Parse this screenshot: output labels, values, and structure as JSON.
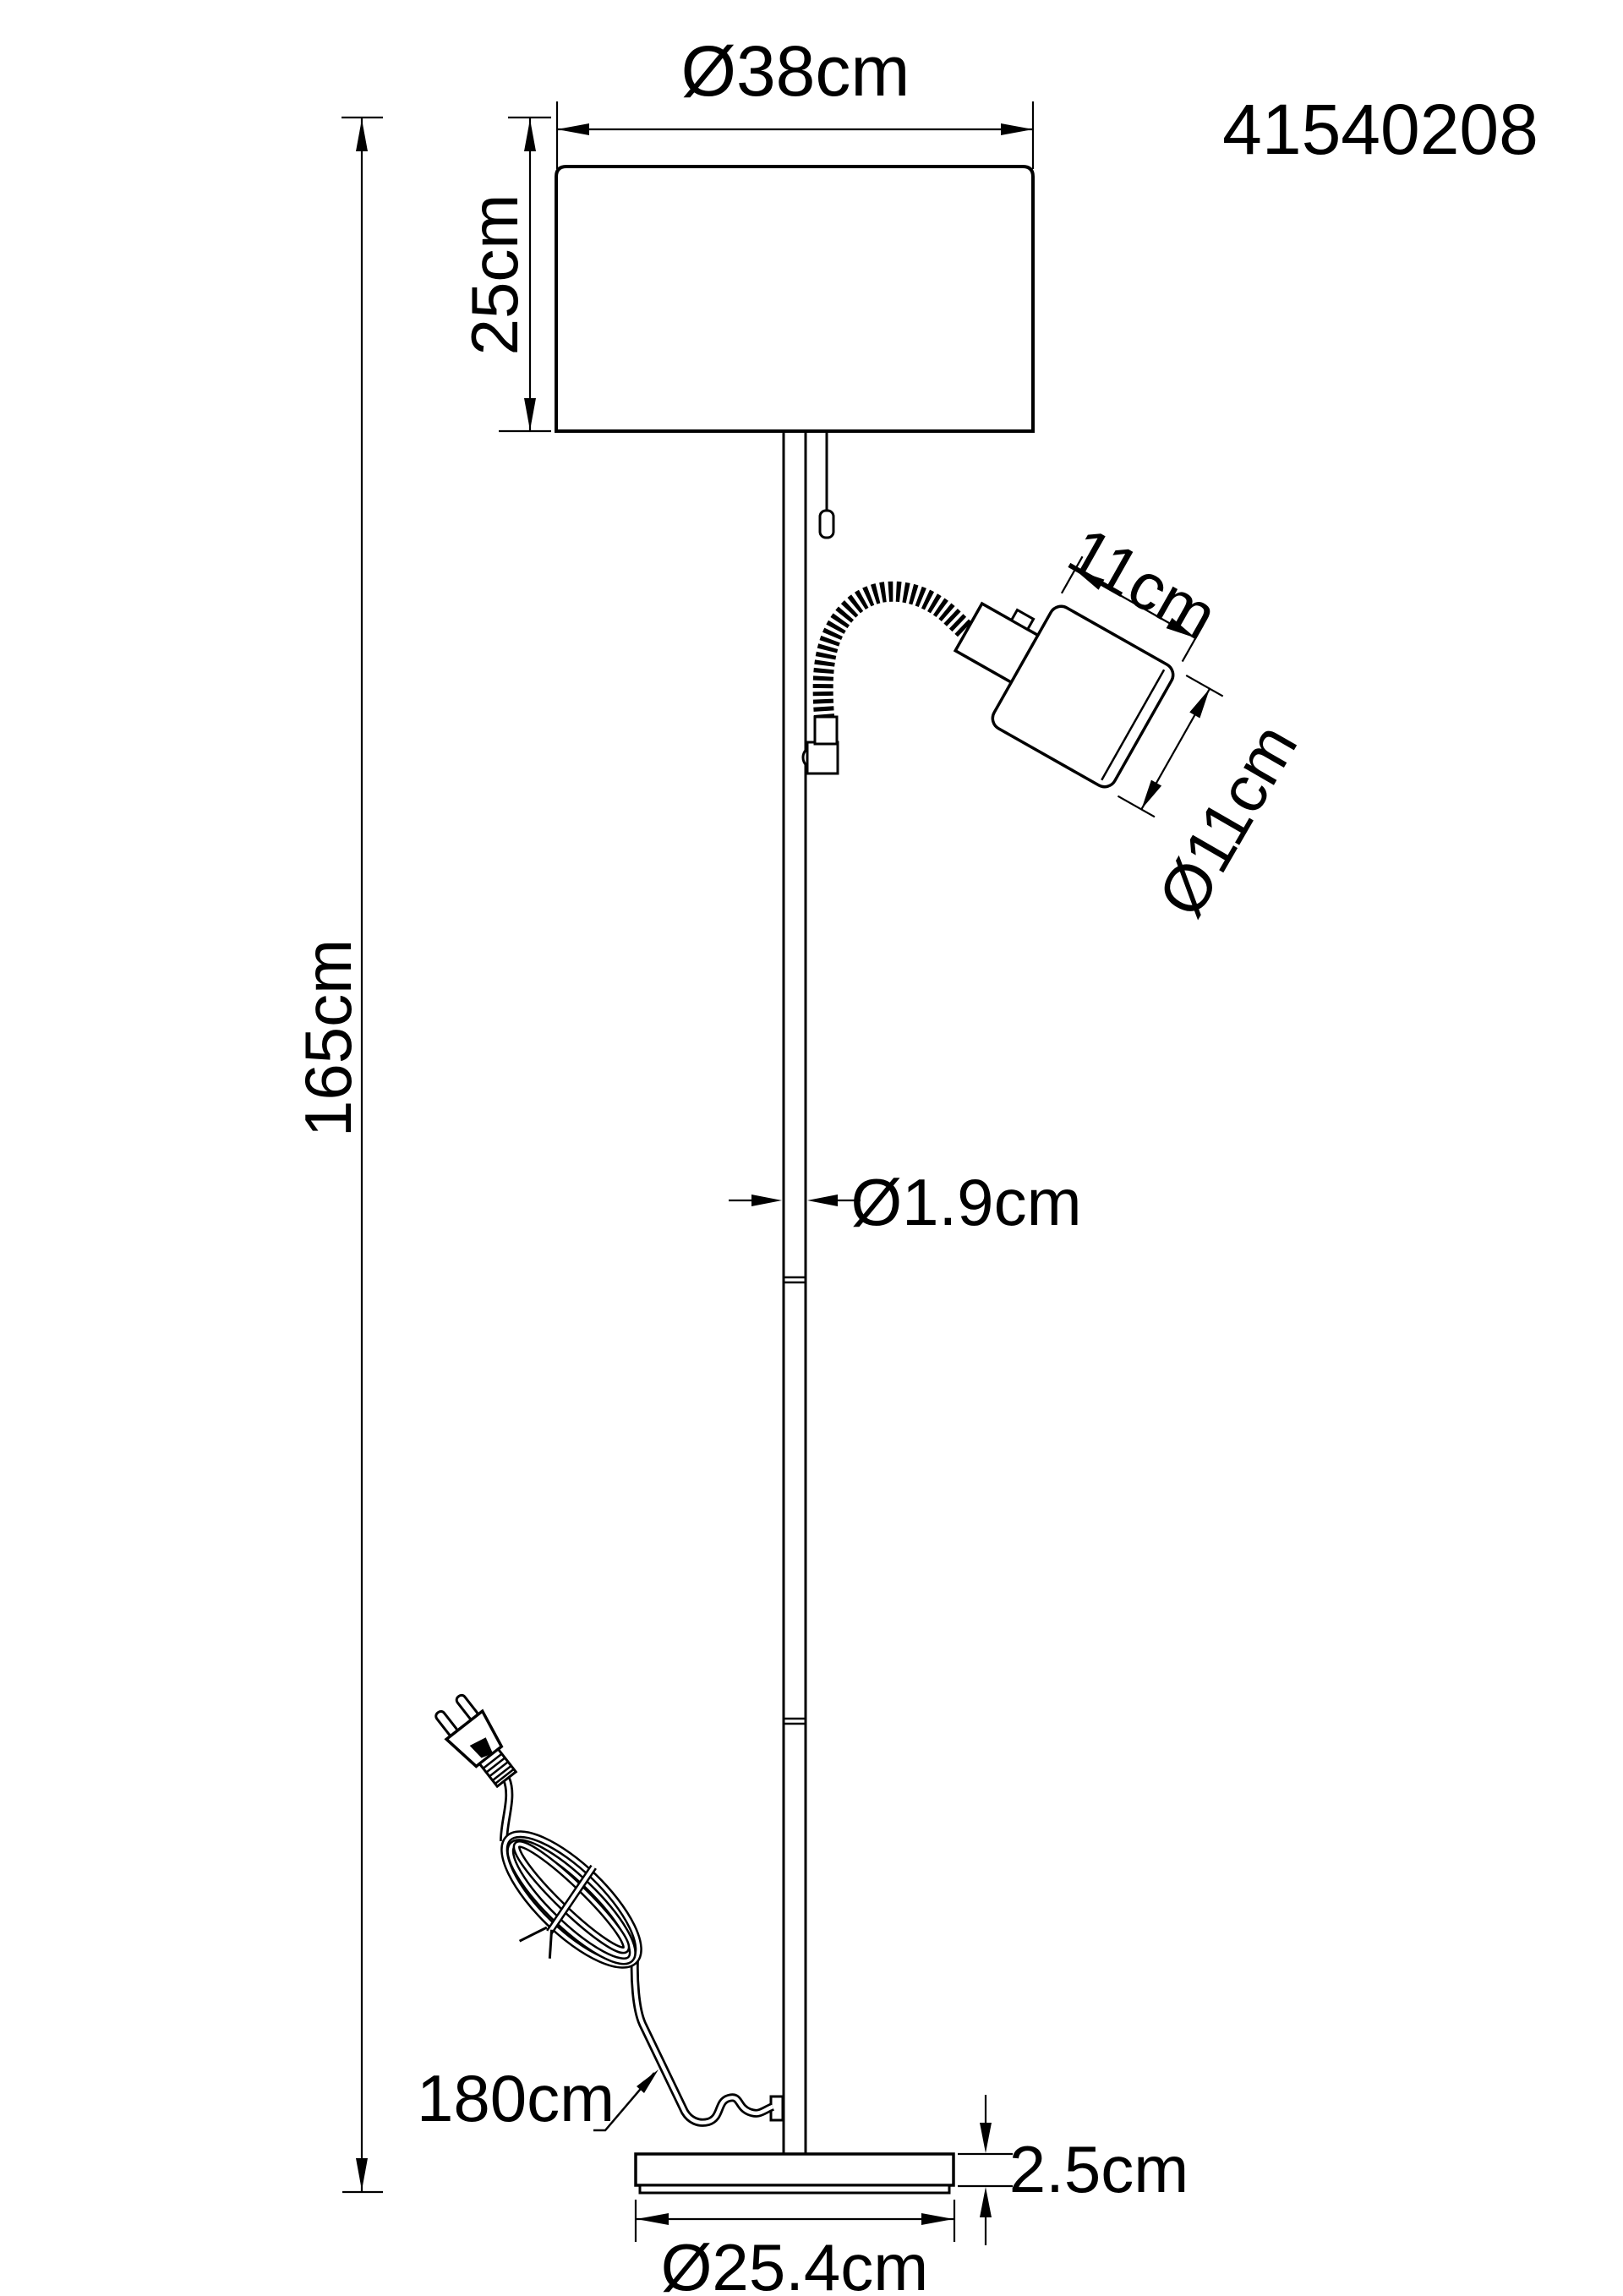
{
  "title": "Floor lamp technical dimension drawing",
  "product": {
    "part_number": "41540208"
  },
  "dimensions": {
    "shade_diameter": "Ø38cm",
    "shade_height": "25cm",
    "total_height": "165cm",
    "reading_head_length": "11cm",
    "reading_head_diameter": "Ø11cm",
    "pole_diameter": "Ø1.9cm",
    "cable_length": "180cm",
    "base_height": "2.5cm",
    "base_diameter": "Ø25.4cm"
  },
  "colors": {
    "line": "#000000",
    "background": "#ffffff",
    "text": "#000000"
  }
}
